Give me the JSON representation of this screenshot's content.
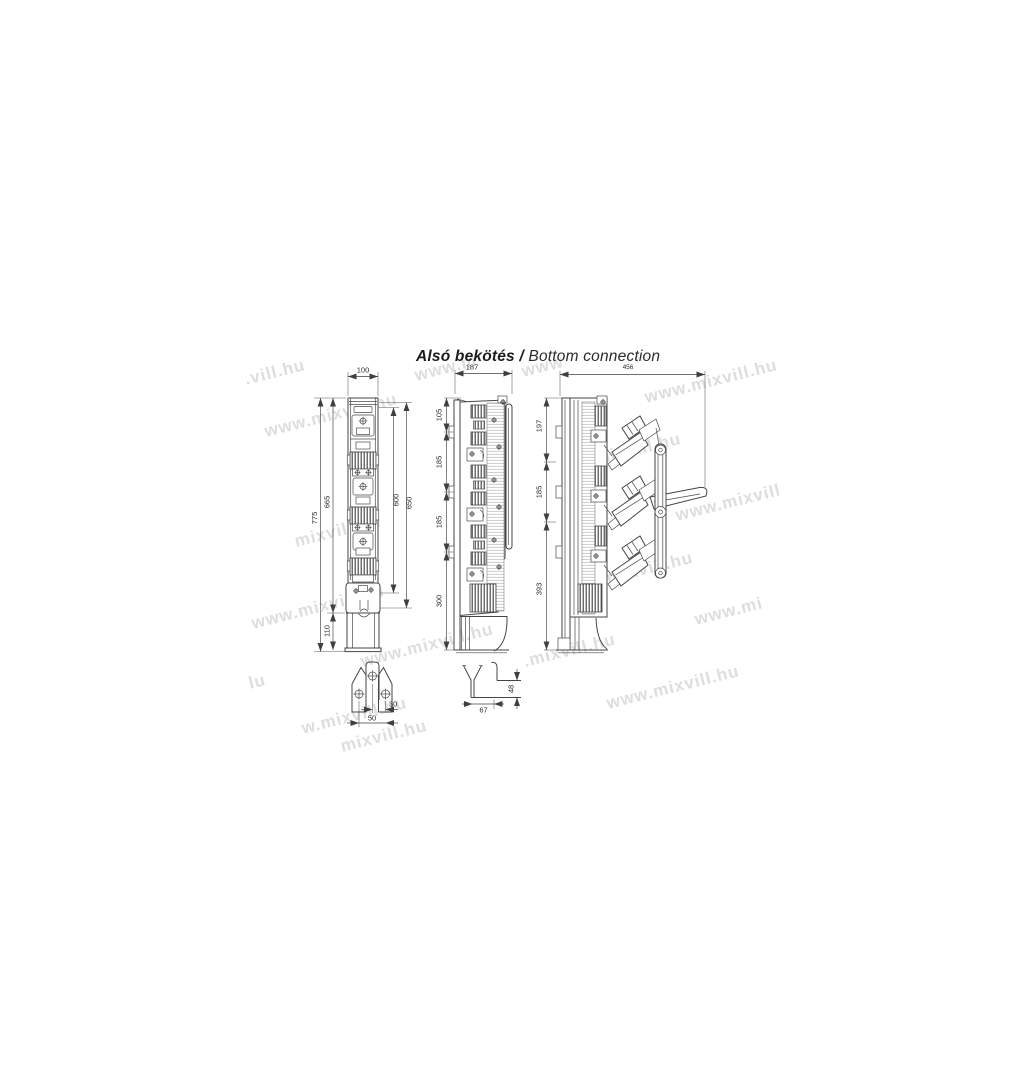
{
  "title": {
    "primary": "Alsó bekötés",
    "separator": " / ",
    "secondary": "Bottom connection"
  },
  "watermark": {
    "text": "www.mixvill.hu",
    "color": "#c9c9c9"
  },
  "watermarks": [
    {
      "text": ".vill.hu",
      "x": 245,
      "y": 380
    },
    {
      "text": "www.m",
      "x": 415,
      "y": 376
    },
    {
      "text": "www",
      "x": 522,
      "y": 372
    },
    {
      "text": "www.mixvill.hu",
      "x": 645,
      "y": 398
    },
    {
      "text": "www.mixvill.hu",
      "x": 265,
      "y": 432
    },
    {
      "text": "mixvill.hu",
      "x": 595,
      "y": 460
    },
    {
      "text": "www.mixvill",
      "x": 676,
      "y": 516
    },
    {
      "text": "mixvill.hu",
      "x": 295,
      "y": 542
    },
    {
      "text": "mixvill.hu",
      "x": 607,
      "y": 579
    },
    {
      "text": "www.mixvill.hu",
      "x": 252,
      "y": 624
    },
    {
      "text": "www.mi",
      "x": 695,
      "y": 620
    },
    {
      "text": "www.mixvill.hu",
      "x": 361,
      "y": 662
    },
    {
      "text": ".mixvill.hu",
      "x": 524,
      "y": 662
    },
    {
      "text": "lu",
      "x": 249,
      "y": 684
    },
    {
      "text": "www.mixvill.hu",
      "x": 607,
      "y": 704
    },
    {
      "text": "w.mixvill.hu",
      "x": 302,
      "y": 729
    },
    {
      "text": "mixvill.hu",
      "x": 341,
      "y": 747
    }
  ],
  "dims": {
    "front_width": "100",
    "front_total_h": "775",
    "front_upper_h": "665",
    "front_lower_h": "110",
    "front_span_inner": "600",
    "front_span_outer": "650",
    "closed_depth": "187",
    "closed_seg1": "105",
    "closed_seg2": "185",
    "closed_seg3": "185",
    "closed_seg4": "300",
    "open_depth": "456",
    "open_seg1": "197",
    "open_seg2": "185",
    "open_seg3": "393",
    "lug_offset": "30",
    "lug_span": "50",
    "bracket_depth": "67",
    "bracket_height": "48"
  }
}
